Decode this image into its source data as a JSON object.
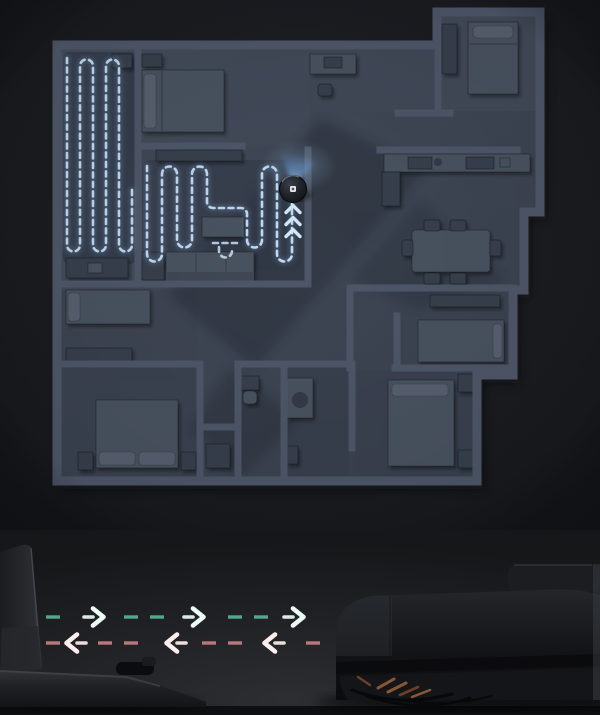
{
  "scene": {
    "type": "robot-vacuum-floorplan-visualization",
    "visible_text": "",
    "icons": {
      "robot_marker": "robot-vacuum-top-view",
      "beam": "lidar-light-beam",
      "chevrons": "triple-chevron-up",
      "outbound_arrows": "dashed-arrow-right",
      "return_arrows": "dashed-arrow-left",
      "dock": "charging-dock-silhouette",
      "robot_product": "robot-vacuum-side-view"
    }
  },
  "colors": {
    "bg": "#17191d",
    "floor": "#3e4654",
    "floor_light": "#454d5c",
    "wall": "#4e5769",
    "furn": "#4a5261",
    "furn_dark": "#39404d",
    "pillow": "#59616f",
    "path": "#c3d9ee",
    "path_glow": "#7fa9d6",
    "cleaned": "#2e3645",
    "beam": "#5b9be0",
    "chevron": "#d2e7fa",
    "robot": "#1c1f24",
    "arrow_green": "#55a78b",
    "arrow_green_head": "#ebfcf4",
    "arrow_red": "#bd767b",
    "arrow_red_head": "#fdeeee",
    "bristle": "#8a5736"
  },
  "map": {
    "robot_marker": {
      "x": 293,
      "y": 189,
      "radius": 13.5
    },
    "beam": {
      "pointing": "up",
      "apex_x": 293,
      "apex_y": 186
    },
    "chevrons": {
      "count": 3,
      "x": 293,
      "y_first": 209,
      "spacing": 12,
      "pointing": "up"
    }
  },
  "bottom": {
    "outbound_row": {
      "direction": "right",
      "y": 87,
      "x_start": 46,
      "x_end": 332,
      "dash": 14,
      "gap": 12,
      "head_positions": [
        100,
        200,
        300
      ]
    },
    "return_row": {
      "direction": "left",
      "y": 113,
      "x_start": 46,
      "x_end": 332,
      "dash": 14,
      "gap": 12,
      "head_positions": [
        70,
        170,
        268
      ]
    }
  }
}
